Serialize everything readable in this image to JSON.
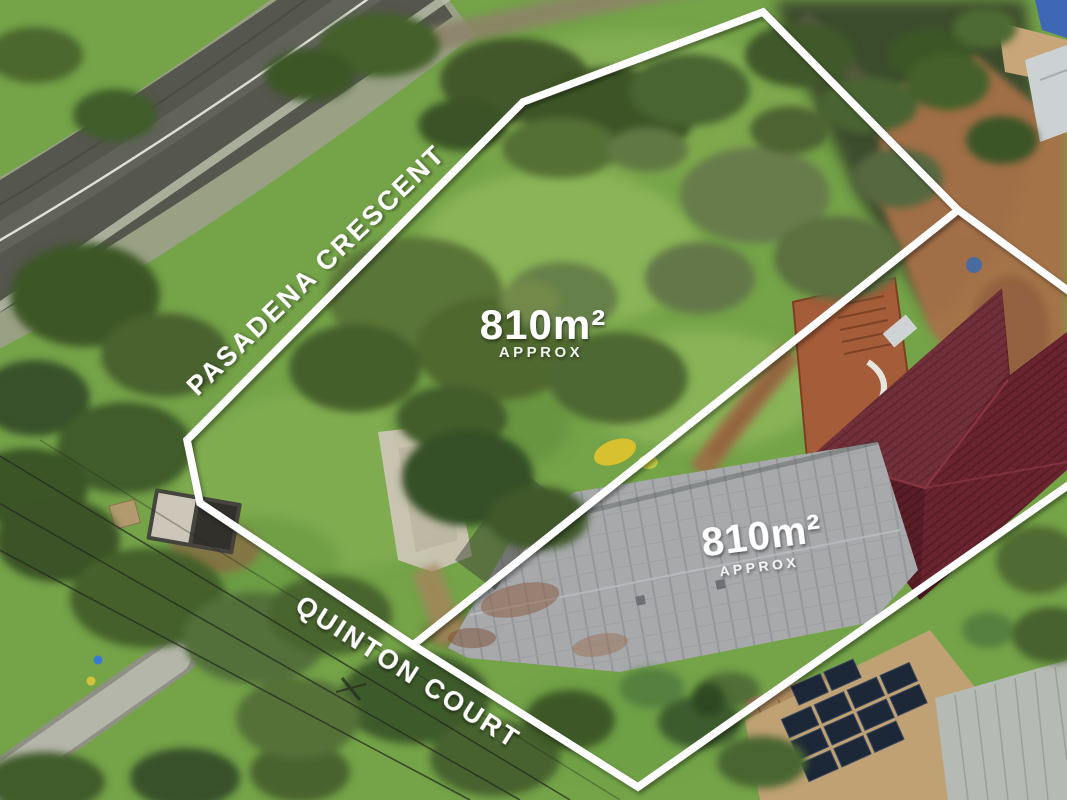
{
  "image_type": "aerial-drone-photograph-real-estate",
  "overlay": {
    "lot1": {
      "area": "810m²",
      "approx": "APPROX"
    },
    "lot2": {
      "area": "810m²",
      "approx": "APPROX"
    },
    "streets": [
      {
        "name": "PASADENA CRESCENT"
      },
      {
        "name": "QUINTON COURT"
      }
    ]
  },
  "colors": {
    "boundary_line": "#ffffff",
    "label_text": "#ffffff",
    "grass_base": "#74a348",
    "road_asphalt": "#55564e",
    "road_marking": "#e9e9e3",
    "red_roof": "#6b2530",
    "gray_roof": "#a7a9ab",
    "solar_panel": "#1c2738",
    "dirt": "#a6714a"
  }
}
